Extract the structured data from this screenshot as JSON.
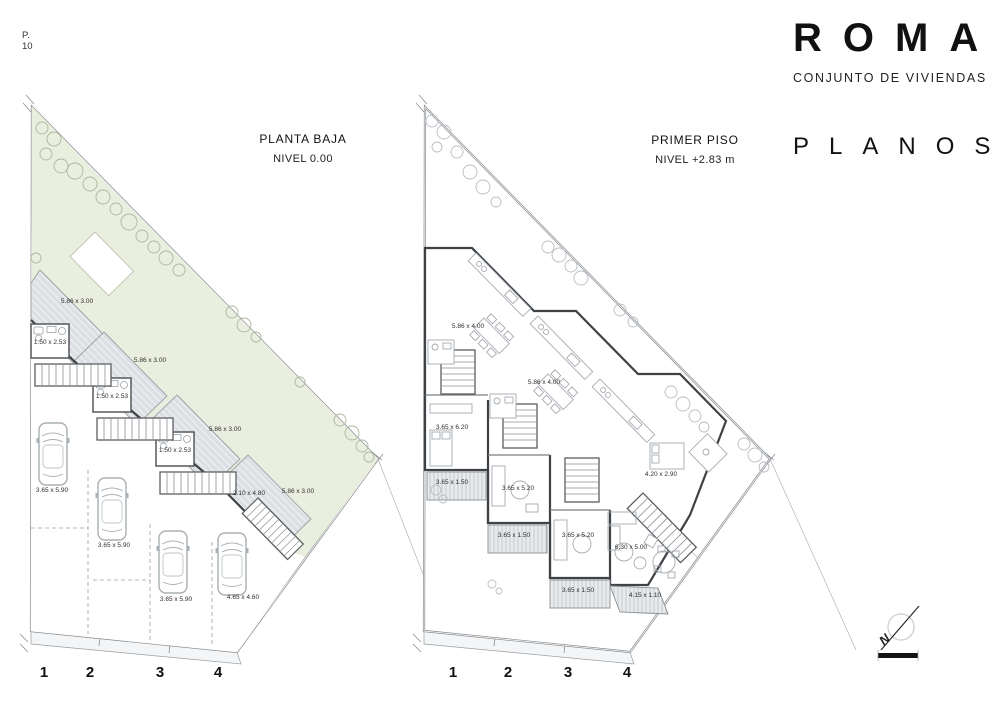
{
  "page": {
    "sheet_label": "P.",
    "sheet_number": "10"
  },
  "titleblock": {
    "project_title": "ROMA",
    "project_subtitle": "CONJUNTO DE VIVIENDAS",
    "sheet_section": "PLANOS"
  },
  "plans": {
    "left": {
      "title": "PLANTA BAJA",
      "level": "NIVEL 0.00",
      "grid": [
        "1",
        "2",
        "3",
        "4"
      ],
      "labels": [
        "5.86 x 3.00",
        "5.86 x 3.00",
        "5.86 x 3.00",
        "5.86 x 3.00",
        "1.50 x 2.53",
        "1.50 x 2.53",
        "1.50 x 2.53",
        "2.10 x 4.80",
        "3.65 x 5.90",
        "3.65 x 5.90",
        "3.65 x 5.90",
        "4.65 x 4.60"
      ]
    },
    "right": {
      "title": "PRIMER PISO",
      "level": "NIVEL +2.83 m",
      "grid": [
        "1",
        "2",
        "3",
        "4"
      ],
      "labels": [
        "5.86 x 4.00",
        "5.86 x 4.00",
        "3.65 x 6.20",
        "3.65 x 1.50",
        "3.65 x 5.20",
        "3.65 x 1.50",
        "3.65 x 5.20",
        "3.65 x 1.50",
        "4.20 x 2.90",
        "6.30 x 5.00",
        "4.15 x 1.10"
      ]
    }
  },
  "compass": {
    "north_label": "N"
  },
  "colors": {
    "garden_green": "#eaeede",
    "deck_gray": "#dcdfe3",
    "wall_dark": "#3f4245",
    "line_gray": "#a6abb0"
  }
}
